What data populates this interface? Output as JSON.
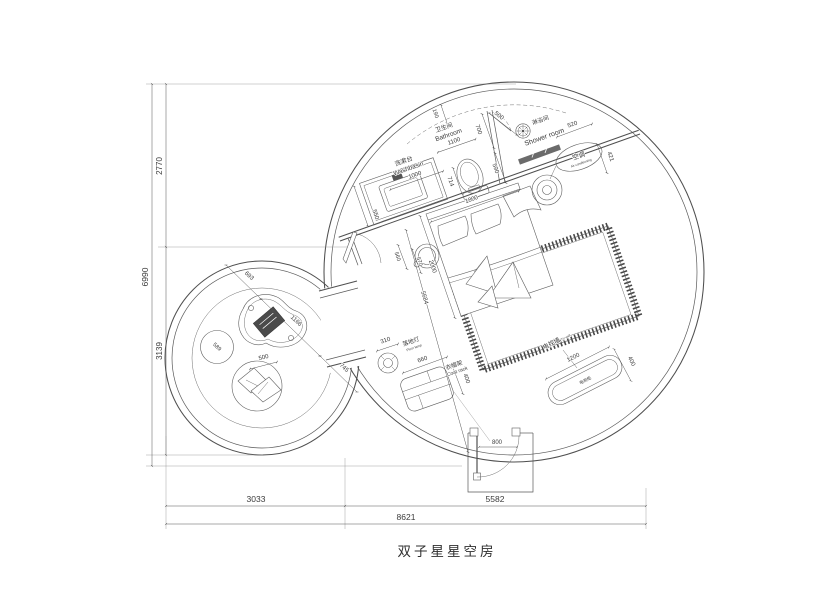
{
  "title": "双子星星空房",
  "labels": {
    "washbasin_zh": "洗漱台",
    "washbasin_en": "Washbasin",
    "bathroom_zh": "卫生间",
    "bathroom_en": "Bathroom",
    "shower_zh": "淋浴间",
    "shower_en": "Shower room",
    "ac_zh": "空调",
    "ac_en": "Air conditioning",
    "lamp_zh": "落地灯",
    "lamp_en": "Floor lamp",
    "rack_zh": "衣帽架",
    "rack_en": "Coat rack",
    "tvwall_zh": "电视墙",
    "tvwall_en": "TV wall",
    "tvcab_zh": "电视柜"
  },
  "dims": {
    "total_w": "8621",
    "w_left": "3033",
    "w_right": "5582",
    "total_h": "6990",
    "h_top": "2770",
    "h_bottom": "3139",
    "d190": "190",
    "d700": "700",
    "d500": "500",
    "d590": "590",
    "d1100": "1100",
    "d1000": "1000",
    "d550": "550",
    "d714": "714",
    "d1800": "1800",
    "d2000": "2000",
    "d560": "560",
    "d570": "570",
    "d520": "520",
    "d421": "421",
    "d5684": "5684",
    "d800": "800",
    "d693": "693",
    "d1166": "1166",
    "d745": "745",
    "d589": "589",
    "d500b": "500",
    "d310": "310",
    "d660": "660",
    "d400a": "400",
    "d1200": "1200",
    "d400b": "400"
  }
}
